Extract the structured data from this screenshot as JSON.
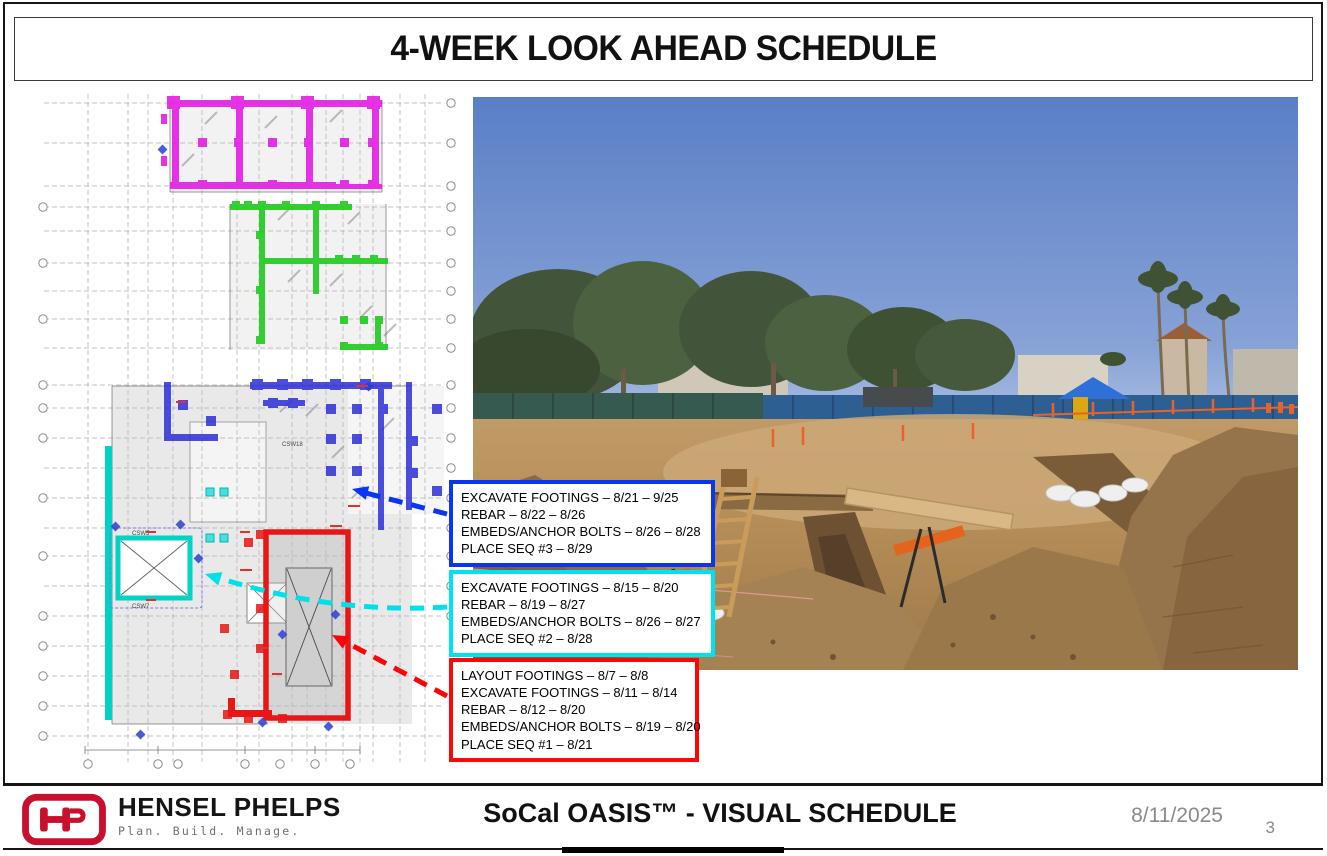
{
  "title_bar": {
    "title": "4-WEEK LOOK AHEAD SCHEDULE"
  },
  "callouts": {
    "seq3": {
      "border_color": "#0A35F2",
      "lines": [
        "EXCAVATE FOOTINGS – 8/21 – 9/25",
        "REBAR – 8/22 – 8/26",
        "EMBEDS/ANCHOR BOLTS – 8/26 – 8/28",
        "PLACE SEQ #3 – 8/29"
      ]
    },
    "seq2": {
      "border_color": "#00E2EE",
      "lines": [
        "EXCAVATE FOOTINGS – 8/15 – 8/20",
        "REBAR – 8/19 – 8/27",
        "EMBEDS/ANCHOR BOLTS – 8/26 – 8/27",
        "PLACE SEQ #2 – 8/28"
      ]
    },
    "seq1": {
      "border_color": "#FB0707",
      "lines": [
        "LAYOUT FOOTINGS – 8/7 – 8/8",
        "EXCAVATE FOOTINGS – 8/11 – 8/14",
        "REBAR – 8/12 – 8/20",
        "EMBEDS/ANCHOR BOLTS – 8/19 – 8/20",
        "PLACE SEQ #1 – 8/21"
      ]
    }
  },
  "plan": {
    "labels": {
      "core_top": "CSW5",
      "core_bottom": "CSW7",
      "wall_mid": "CSW18"
    },
    "highlight_colors": {
      "sequence_area_magenta": "#E318E3",
      "sequence_area_green": "#1ECB1E",
      "sequence_area_blue": "#2F2FD8",
      "sequence_area_cyan": "#00D2C4",
      "sequence_area_red": "#E81616"
    }
  },
  "photo": {
    "description": "construction site excavation with trenches, ladder, sandbags and safety barricades"
  },
  "footer": {
    "company_name": "HENSEL PHELPS",
    "tagline": "Plan. Build. Manage.",
    "project_title": "SoCal OASIS™ - VISUAL SCHEDULE",
    "date": "8/11/2025",
    "page_number": "3",
    "brand_red": "#C8102E"
  }
}
